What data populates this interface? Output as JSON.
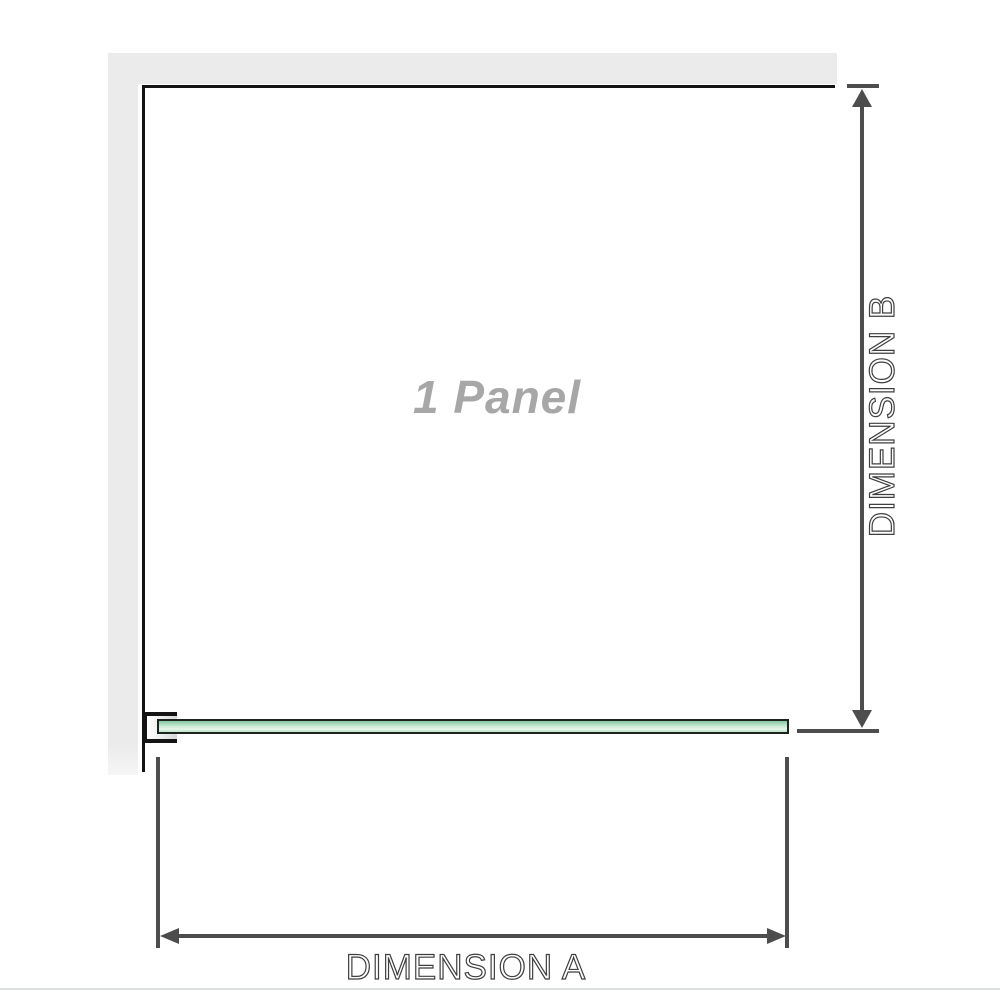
{
  "diagram": {
    "panel_label": "1 Panel",
    "dimension_a": {
      "label": "DIMENSION A",
      "orientation": "horizontal"
    },
    "dimension_b": {
      "label": "DIMENSION B",
      "orientation": "vertical"
    },
    "icons": {
      "arrow_up": "arrow-up-icon",
      "arrow_down": "arrow-down-icon",
      "arrow_left": "arrow-left-icon",
      "arrow_right": "arrow-right-icon"
    },
    "colors": {
      "wall_gray": "#ebebeb",
      "outline_black": "#141414",
      "dimension_line_gray": "#4d4d4d",
      "dimension_text": "#3f3f3f",
      "panel_label_gray": "#a7a7a7",
      "glass_green_dark": "#84c6a2",
      "glass_green_light": "#e7f5eb",
      "footer_line_gray": "#dde1dd"
    }
  }
}
